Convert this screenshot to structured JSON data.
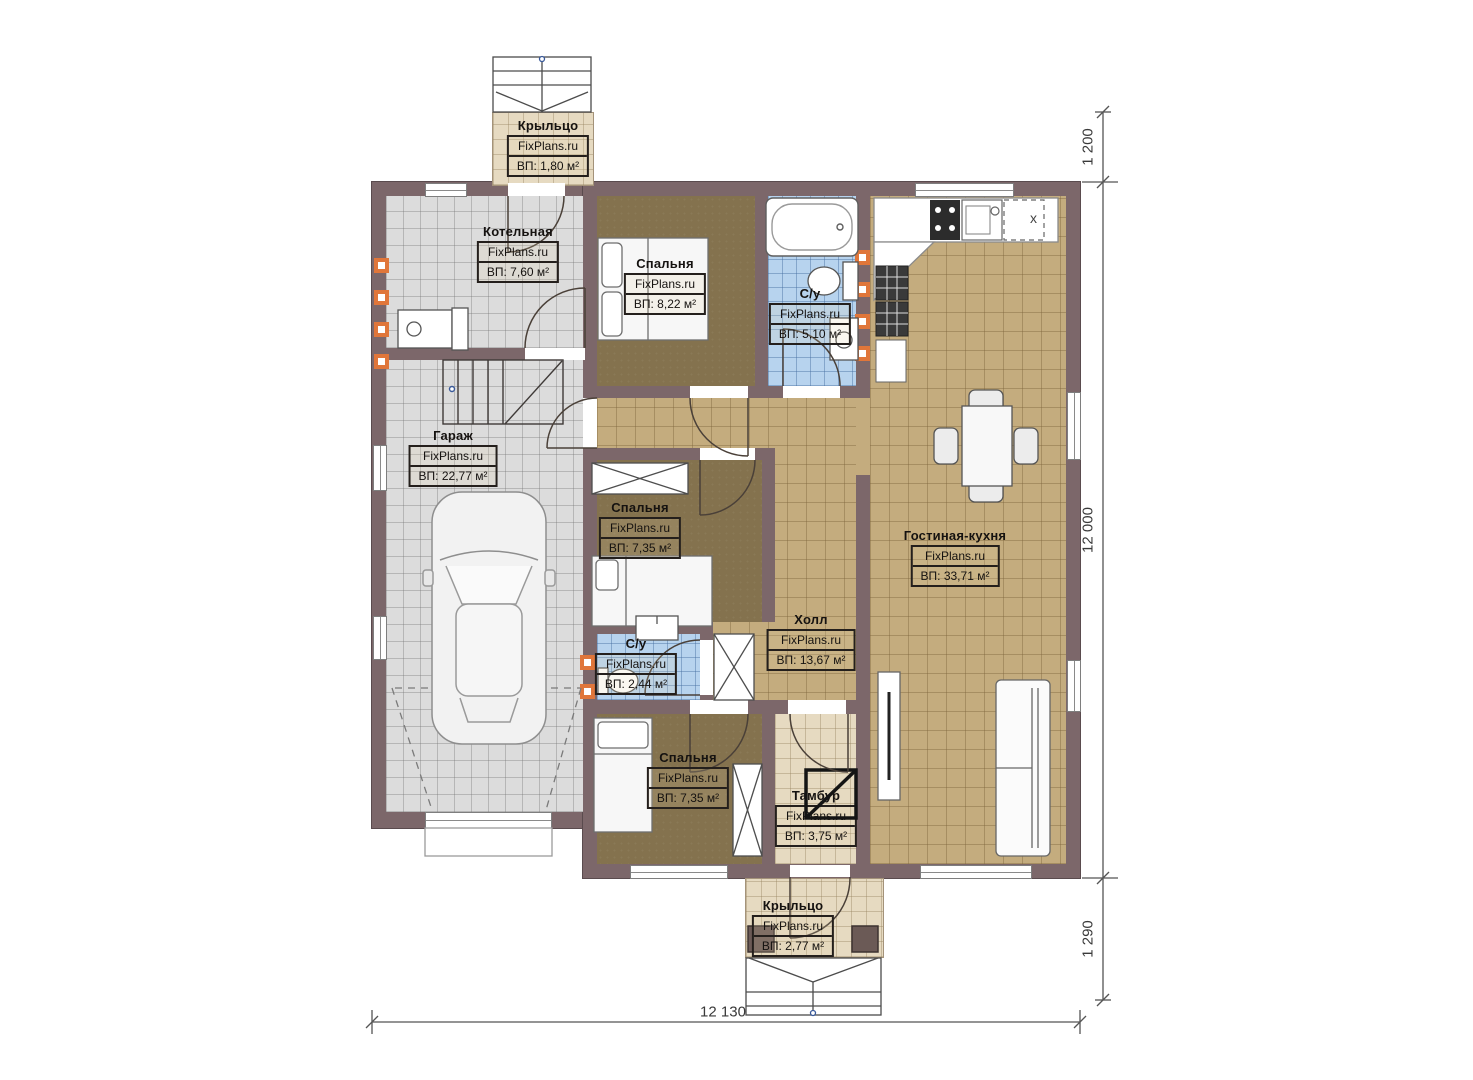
{
  "plan": {
    "brand": "FixPlans.ru",
    "rooms": [
      {
        "name": "Крыльцо",
        "area": "ВП: 1,80 м²"
      },
      {
        "name": "Котельная",
        "area": "ВП: 7,60 м²"
      },
      {
        "name": "Спальня",
        "area": "ВП: 8,22 м²"
      },
      {
        "name": "С/у",
        "area": "ВП: 5,10 м²"
      },
      {
        "name": "Гараж",
        "area": "ВП: 22,77 м²"
      },
      {
        "name": "Спальня",
        "area": "ВП: 7,35 м²"
      },
      {
        "name": "Гостиная-кухня",
        "area": "ВП: 33,71 м²"
      },
      {
        "name": "Холл",
        "area": "ВП: 13,67 м²"
      },
      {
        "name": "С/у",
        "area": "ВП: 2,44 м²"
      },
      {
        "name": "Спальня",
        "area": "ВП: 7,35 м²"
      },
      {
        "name": "Тамбур",
        "area": "ВП: 3,75 м²"
      },
      {
        "name": "Крыльцо",
        "area": "ВП: 2,77 м²"
      }
    ],
    "dimensions": {
      "top_right": "1 200",
      "right": "12 000",
      "bottom_right": "1 290",
      "bottom": "12 130"
    },
    "kitchen": {
      "marker": "x"
    },
    "colors": {
      "wall": "#7c676a",
      "tile_gray": "#dcdcdc",
      "tile_tan": "#c4ac7e",
      "tile_blue": "#b7d3ee",
      "floor_brown": "#84724e",
      "porch_beige": "#e6dac1",
      "accent_orange": "#e0763a"
    }
  }
}
